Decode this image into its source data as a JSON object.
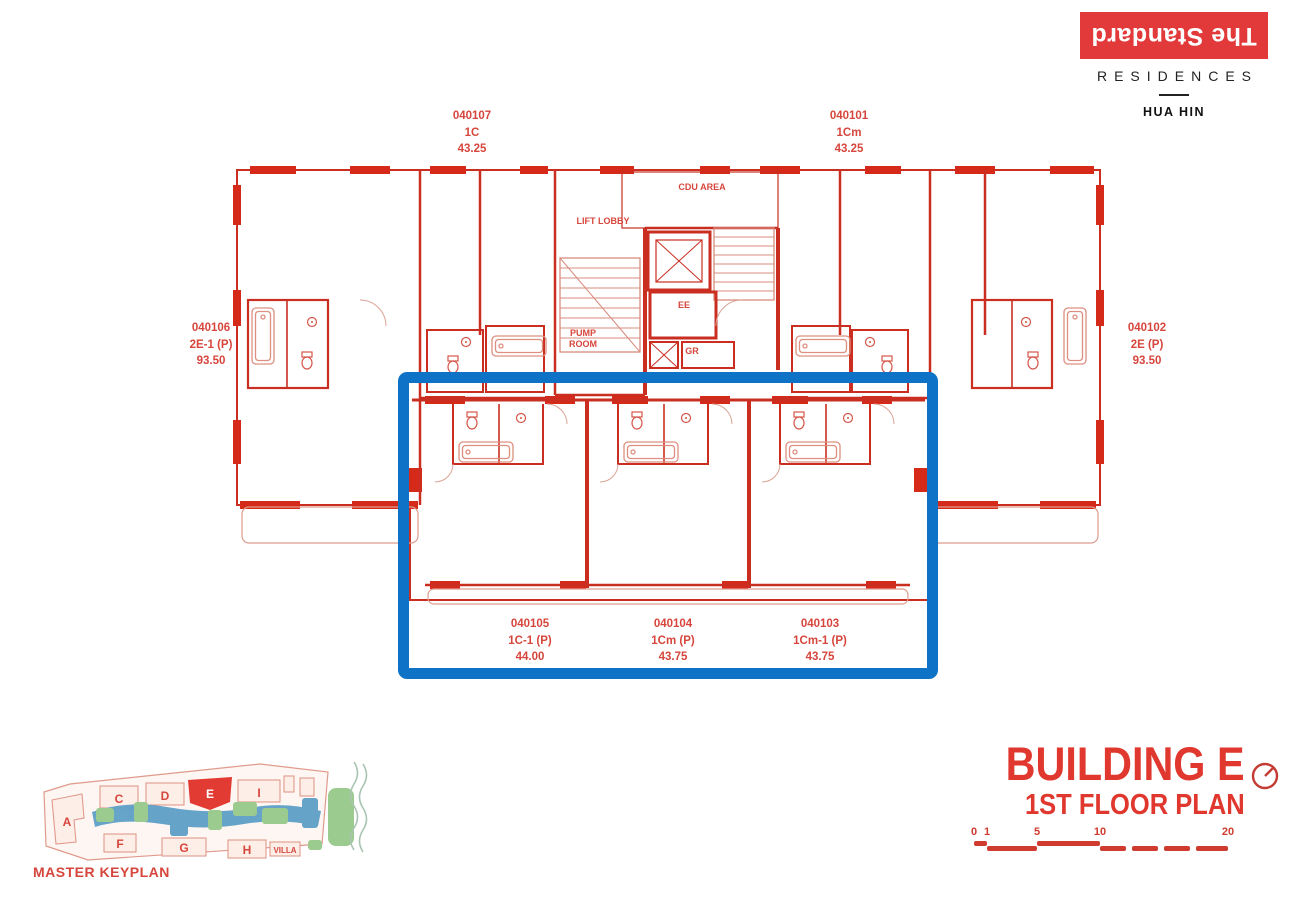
{
  "brand": {
    "name": "The Standard",
    "sub": "RESIDENCES",
    "city": "HUA HIN"
  },
  "rooms": {
    "cdu_area": "CDU AREA",
    "lift_lobby": "LIFT LOBBY",
    "ee": "EE",
    "pump_room": "PUMP ROOM",
    "gr": "GR"
  },
  "units": [
    {
      "id": "040107",
      "type": "1C",
      "area": "43.25"
    },
    {
      "id": "040101",
      "type": "1Cm",
      "area": "43.25"
    },
    {
      "id": "040106",
      "type": "2E-1 (P)",
      "area": "93.50"
    },
    {
      "id": "040102",
      "type": "2E (P)",
      "area": "93.50"
    },
    {
      "id": "040105",
      "type": "1C-1 (P)",
      "area": "44.00"
    },
    {
      "id": "040104",
      "type": "1Cm (P)",
      "area": "43.75"
    },
    {
      "id": "040103",
      "type": "1Cm-1 (P)",
      "area": "43.75"
    }
  ],
  "titleblock": {
    "building": "BUILDING E",
    "floor": "1ST FLOOR PLAN"
  },
  "scale": {
    "ticks": [
      "0",
      "1",
      "5",
      "10",
      "20"
    ]
  },
  "keyplan": {
    "title": "MASTER KEYPLAN",
    "letters": [
      "A",
      "C",
      "D",
      "E",
      "I",
      "F",
      "G",
      "H"
    ],
    "villa": "VILLA",
    "highlighted": "E"
  },
  "colors": {
    "brand_red": "#e23a3a",
    "plan_red": "#c92e20",
    "label_red": "#d6463c",
    "title_red": "#e0372e",
    "highlight_blue": "#0e73c6",
    "keyplan_water": "#5e9fc7",
    "keyplan_green": "#9bcb8e"
  }
}
